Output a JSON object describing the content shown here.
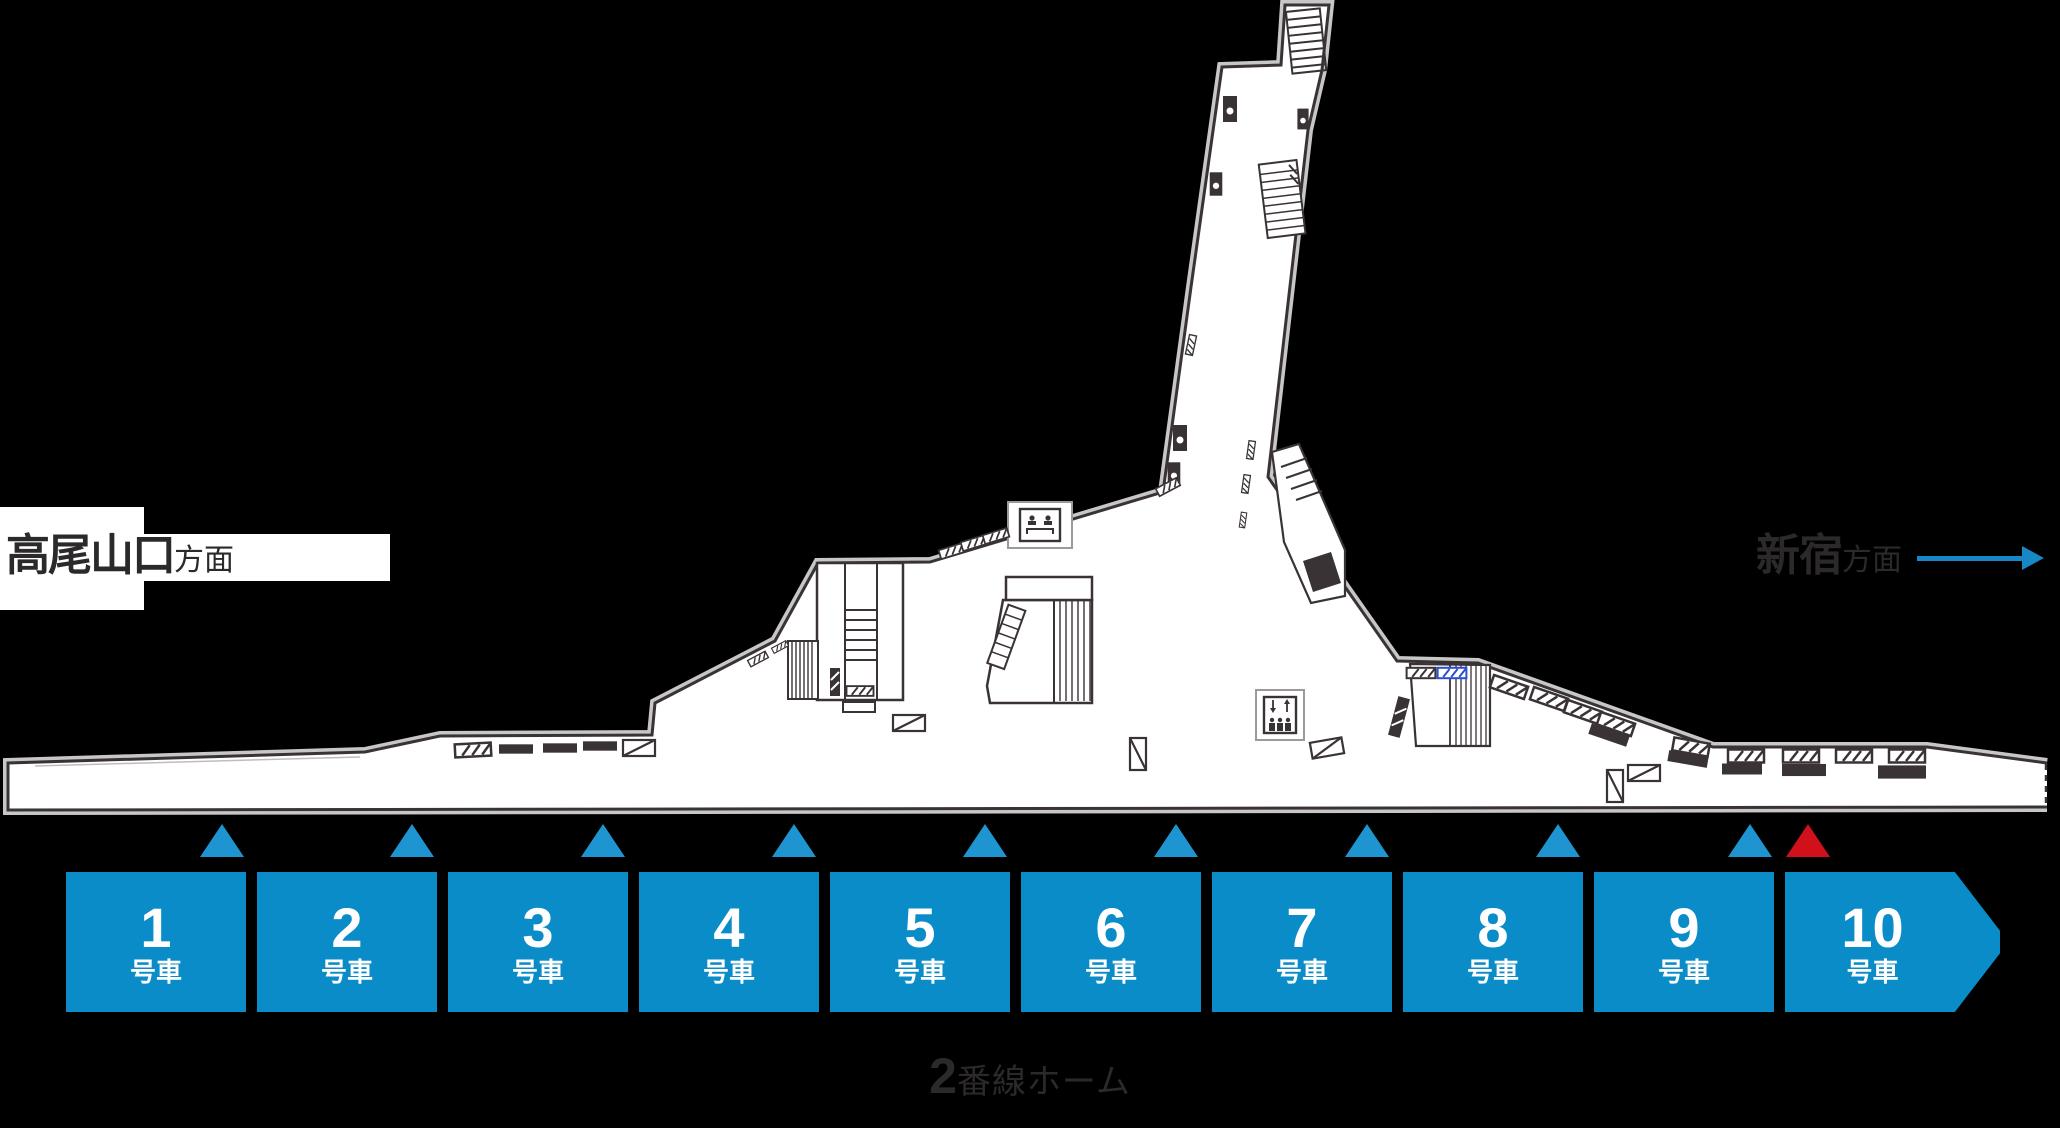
{
  "map": {
    "left_direction": {
      "station": "高尾山口",
      "suffix": "方面"
    },
    "right_direction": {
      "station": "新宿",
      "suffix": "方面"
    },
    "platform_label": {
      "number": "2",
      "suffix": "番線ホーム"
    },
    "cars": [
      {
        "number": "1",
        "label": "号車"
      },
      {
        "number": "2",
        "label": "号車"
      },
      {
        "number": "3",
        "label": "号車"
      },
      {
        "number": "4",
        "label": "号車"
      },
      {
        "number": "5",
        "label": "号車"
      },
      {
        "number": "6",
        "label": "号車"
      },
      {
        "number": "7",
        "label": "号車"
      },
      {
        "number": "8",
        "label": "号車"
      },
      {
        "number": "9",
        "label": "号車"
      },
      {
        "number": "10",
        "label": "号車"
      }
    ],
    "markers": [
      {
        "style": "blue",
        "x": 222
      },
      {
        "style": "blue",
        "x": 412
      },
      {
        "style": "blue",
        "x": 603
      },
      {
        "style": "blue",
        "x": 794
      },
      {
        "style": "blue",
        "x": 985
      },
      {
        "style": "blue",
        "x": 1176
      },
      {
        "style": "blue",
        "x": 1367
      },
      {
        "style": "blue",
        "x": 1558
      },
      {
        "style": "blue",
        "x": 1750
      },
      {
        "style": "red",
        "x": 1808
      }
    ],
    "colors": {
      "background": "#000000",
      "platform_fill": "#ffffff",
      "drawing_outline": "#3a3335",
      "drawing_outline_halo": "#c7c7c7",
      "car_box_blue": "#0a8cc8",
      "marker_blue": "#1e95d1",
      "marker_red": "#d0101b",
      "arrow_blue": "#1787c6",
      "sign_blue_outline": "#2b4fd0",
      "label_text": "#2b292a"
    },
    "icons": {
      "stairs": "ladder-rung band",
      "escalator": "striped band",
      "elevator": "box with down/up arrows and three figures",
      "waiting_room": "box with two seated figures",
      "pillar": "dark square with white dot",
      "hatched_sign": "white rectangle with diagonal stripes",
      "solid_dash": "black filled rectangle",
      "diagonal_sign": "white rectangle with single diagonal",
      "platform_edge_continuation": "dashed vertical line"
    }
  }
}
